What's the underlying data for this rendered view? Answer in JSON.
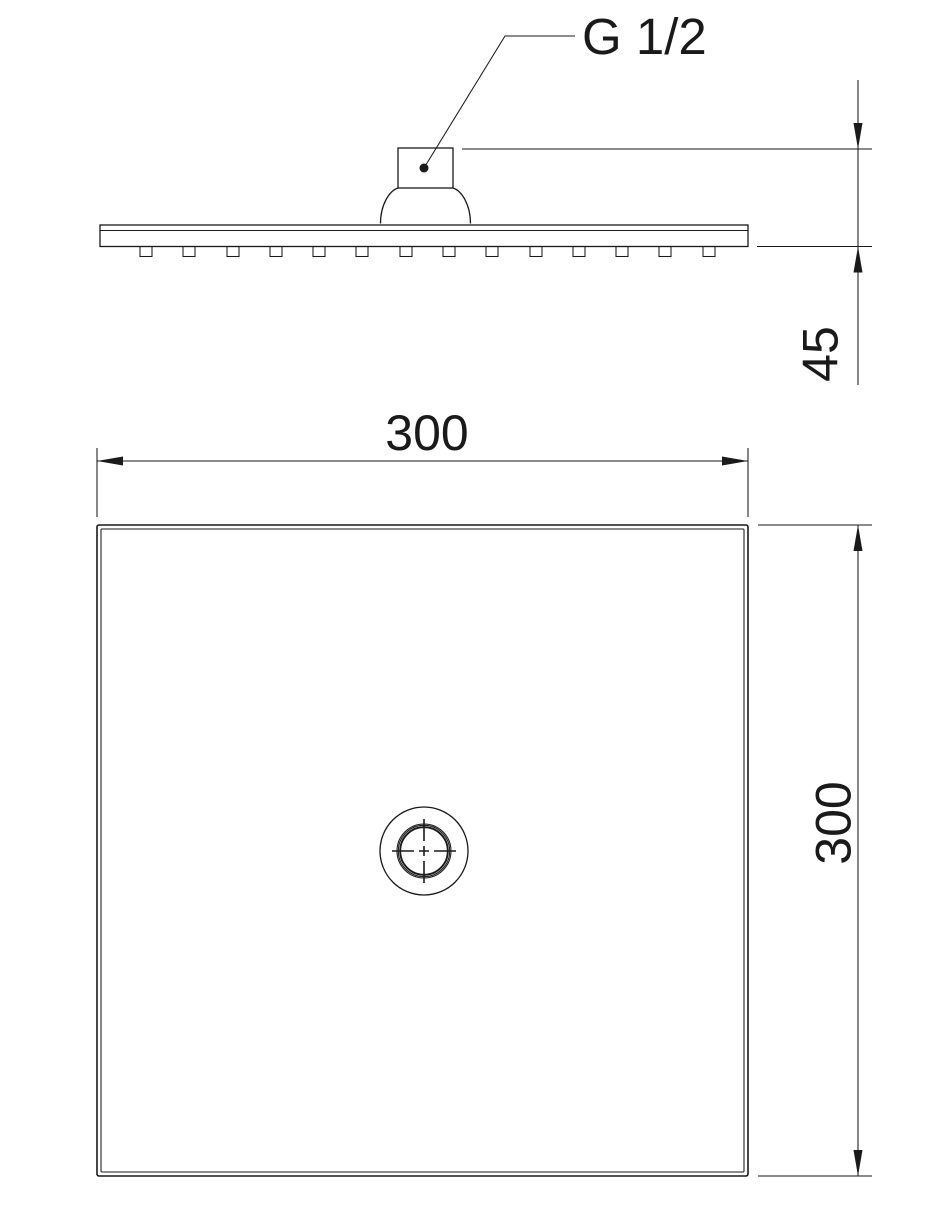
{
  "diagram": {
    "kind": "technical-dimension-drawing",
    "subject": "square overhead shower head, side view and plan view",
    "labels": {
      "thread": "G 1/2",
      "width": "300",
      "depth": "300",
      "height": "45"
    },
    "colors": {
      "line": "#1a1a1a",
      "background": "#ffffff"
    }
  }
}
